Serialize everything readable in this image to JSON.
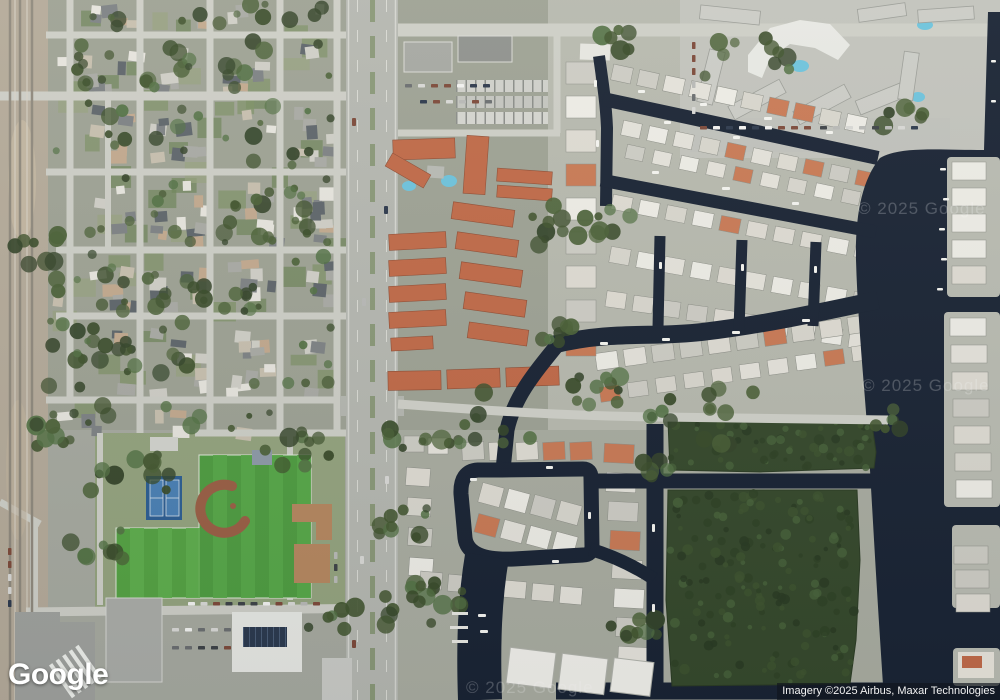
{
  "window": {
    "width": 1000,
    "height": 700
  },
  "map": {
    "view_type": "satellite",
    "logo_text": "Google",
    "attribution_text": "Imagery ©2025 Airbus, Maxar Technologies",
    "watermark_text": "© 2025 Google",
    "colors": {
      "residential_base": "#9ea294",
      "canal_base": "#b7b9ae",
      "south_base": "#a9aca0",
      "park_base": "#94a37e",
      "railroad_base": "#b4aa99",
      "road": "#cdcec6",
      "road_major": "#b5b7b0",
      "water": "#1a2434",
      "mangrove": "#36492c",
      "field_green": "#4f9c41",
      "field_green_alt": "#58a849",
      "tennis_blue": "#2d5e92",
      "tennis_court": "#4a80b4",
      "clay": "#9a5f45",
      "roof_orange": "#c06a48",
      "school_tan": "#b5875f",
      "pool": "#6ec3dc"
    },
    "regions": [
      {
        "name": "railroad-corridor",
        "description": "Railroad tracks running along the far left edge"
      },
      {
        "name": "residential-grid",
        "description": "Suburban street grid with single-family homes and heavy tree cover, left half"
      },
      {
        "name": "main-highway",
        "description": "North-south divided highway through the center-left"
      },
      {
        "name": "townhome-complex",
        "description": "Rows of orange terracotta-roofed townhomes with two pools, center"
      },
      {
        "name": "canal-neighborhood",
        "description": "Waterfront homes with boats and docks along finger canals, upper right"
      },
      {
        "name": "condo-complex",
        "description": "Large condominium complex with pools and parking, top right"
      },
      {
        "name": "intracoastal-waterway",
        "description": "Dark waterway running down the right edge with homes on the far bank"
      },
      {
        "name": "mangrove-preserve",
        "description": "Dense dark-green mangrove stands separated by canals, lower right"
      },
      {
        "name": "island-loop-neighborhood",
        "description": "Canal loop with homes and marina docks, bottom center"
      },
      {
        "name": "sports-park",
        "description": "Bright green athletic fields with a baseball diamond, tennis courts and tan school buildings, bottom left"
      },
      {
        "name": "commercial-blocks",
        "description": "Flat-roofed commercial buildings (one with rooftop solar) and parking lots along the bottom"
      }
    ]
  }
}
